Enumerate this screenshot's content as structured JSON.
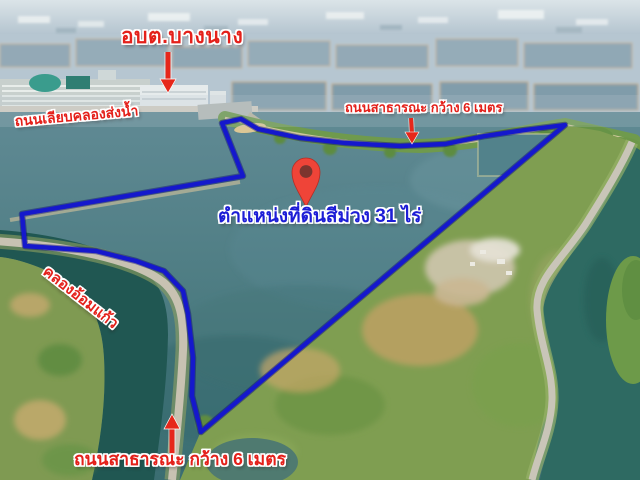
{
  "photo": {
    "labels": {
      "obt": {
        "text": "อบต.บางนาง"
      },
      "canal_road": {
        "text": "ถนนเลียบคลองส่งน้ำ"
      },
      "public_road_top": {
        "text": "ถนนสาธารณะ กว้าง 6 เมตร"
      },
      "parcel": {
        "text": "ตำแหน่งที่ดินสีม่วง 31 ไร่"
      },
      "khlong": {
        "text": "คลองอ้อมแก้ว"
      },
      "public_road_bottom": {
        "text": "ถนนสาธารณะ กว้าง 6 เมตร"
      }
    },
    "colors": {
      "label_red": "#e4201a",
      "label_blue": "#1d1dd6",
      "boundary_blue": "#1518cc",
      "arrow_red": "#e6271b",
      "pin_red": "#ef4438"
    }
  }
}
